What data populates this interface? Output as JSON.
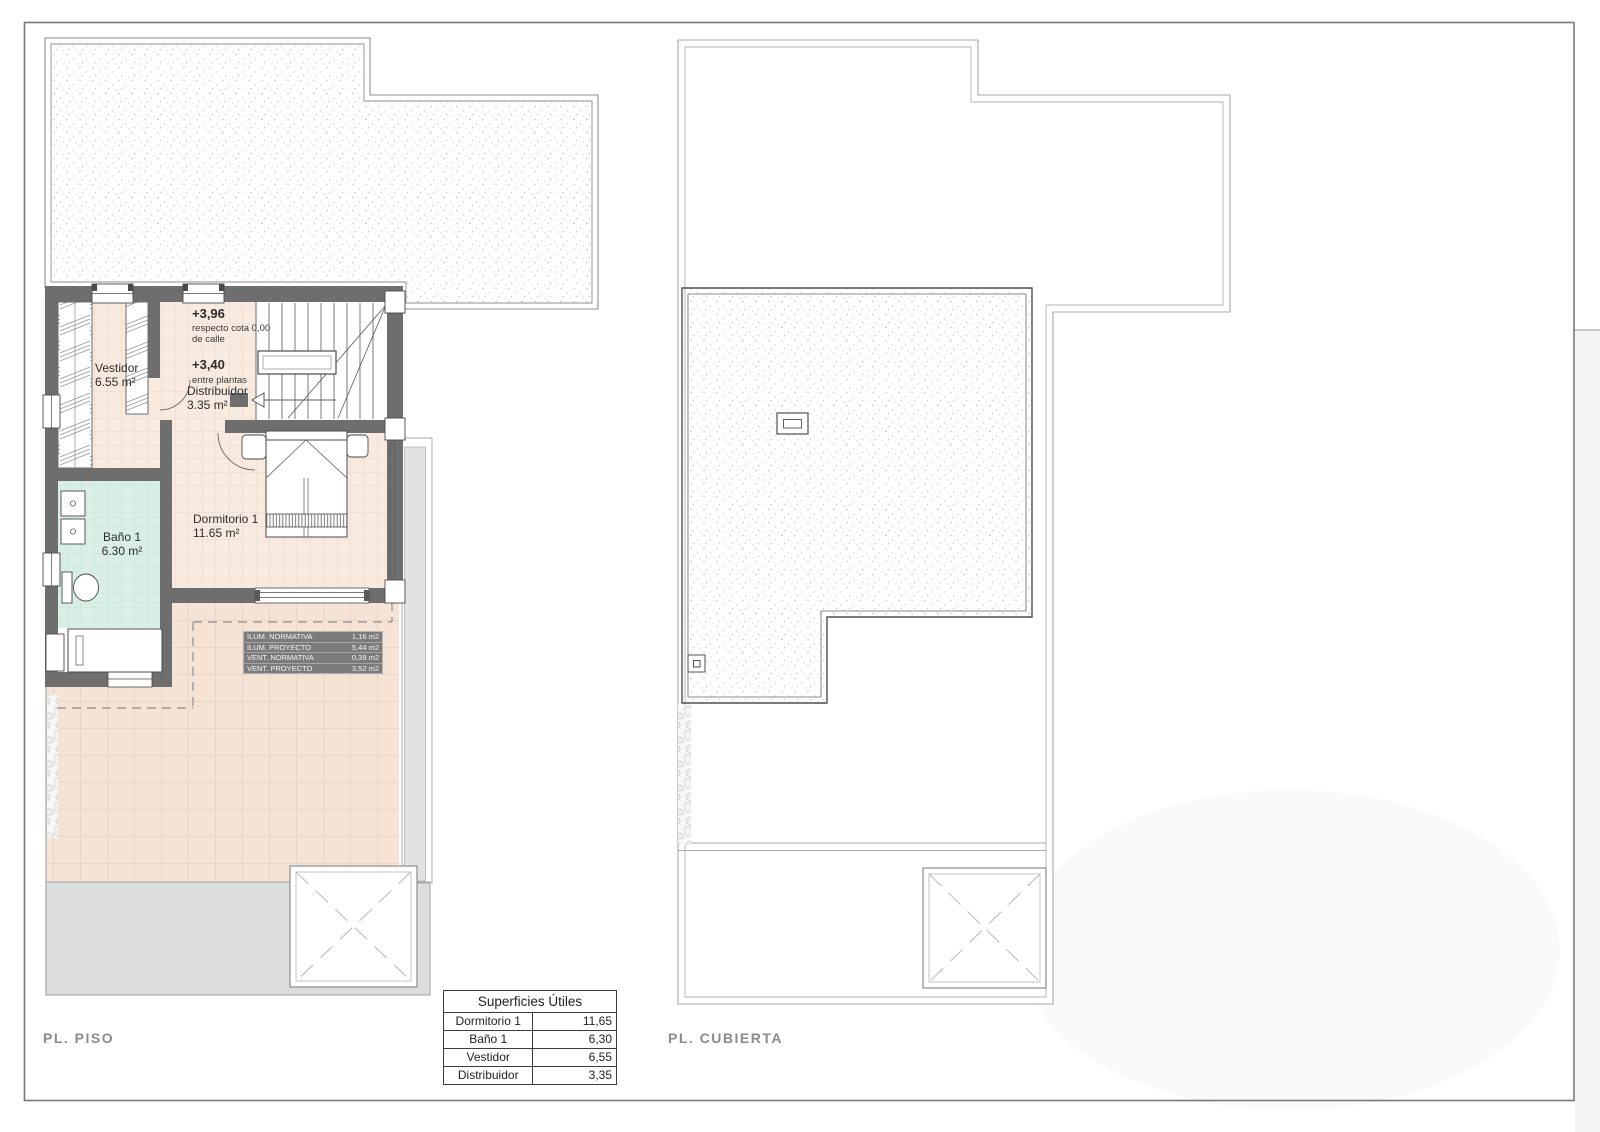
{
  "plans": {
    "piso": {
      "title": "PL. PISO",
      "rooms": {
        "vestidor": {
          "name": "Vestidor",
          "area": "6.55 m²"
        },
        "bano": {
          "name": "Baño 1",
          "area": "6.30 m²"
        },
        "dormitorio": {
          "name": "Dormitorio 1",
          "area": "11.65 m²"
        },
        "distribuidor": {
          "name": "Distribuidor",
          "area": "3.35 m²"
        }
      },
      "levels": {
        "upper": {
          "value": "+3,96",
          "line1": "respecto cota 0,00",
          "line2": "de calle"
        },
        "mid": {
          "value": "+3,40",
          "line1": "entre plantas"
        }
      },
      "norm_table": {
        "rows": [
          {
            "label": "ILUM. NORMATIVA",
            "value": "1,16 m2"
          },
          {
            "label": "ILUM. PROYECTO",
            "value": "5,44 m2"
          },
          {
            "label": "VENT. NORMATIVA",
            "value": "0,39 m2"
          },
          {
            "label": "VENT. PROYECTO",
            "value": "3,52 m2"
          }
        ]
      }
    },
    "cubierta": {
      "title": "PL. CUBIERTA"
    }
  },
  "areas_table": {
    "title": "Superficies Útiles",
    "rows": [
      {
        "room": "Dormitorio 1",
        "area": "11,65"
      },
      {
        "room": "Baño 1",
        "area": "6,30"
      },
      {
        "room": "Vestidor",
        "area": "6,55"
      },
      {
        "room": "Distribuidor",
        "area": "3,35"
      }
    ]
  },
  "colors": {
    "wall": "#6e6e6e",
    "room_floor": "#f8eadf",
    "terrace_floor": "#f5e3d5",
    "bath_floor": "#d9efe5",
    "paved_gray": "#dcdddd",
    "norm_table_bg": "#7b7b7b",
    "title_gray": "#8b8b8b"
  }
}
